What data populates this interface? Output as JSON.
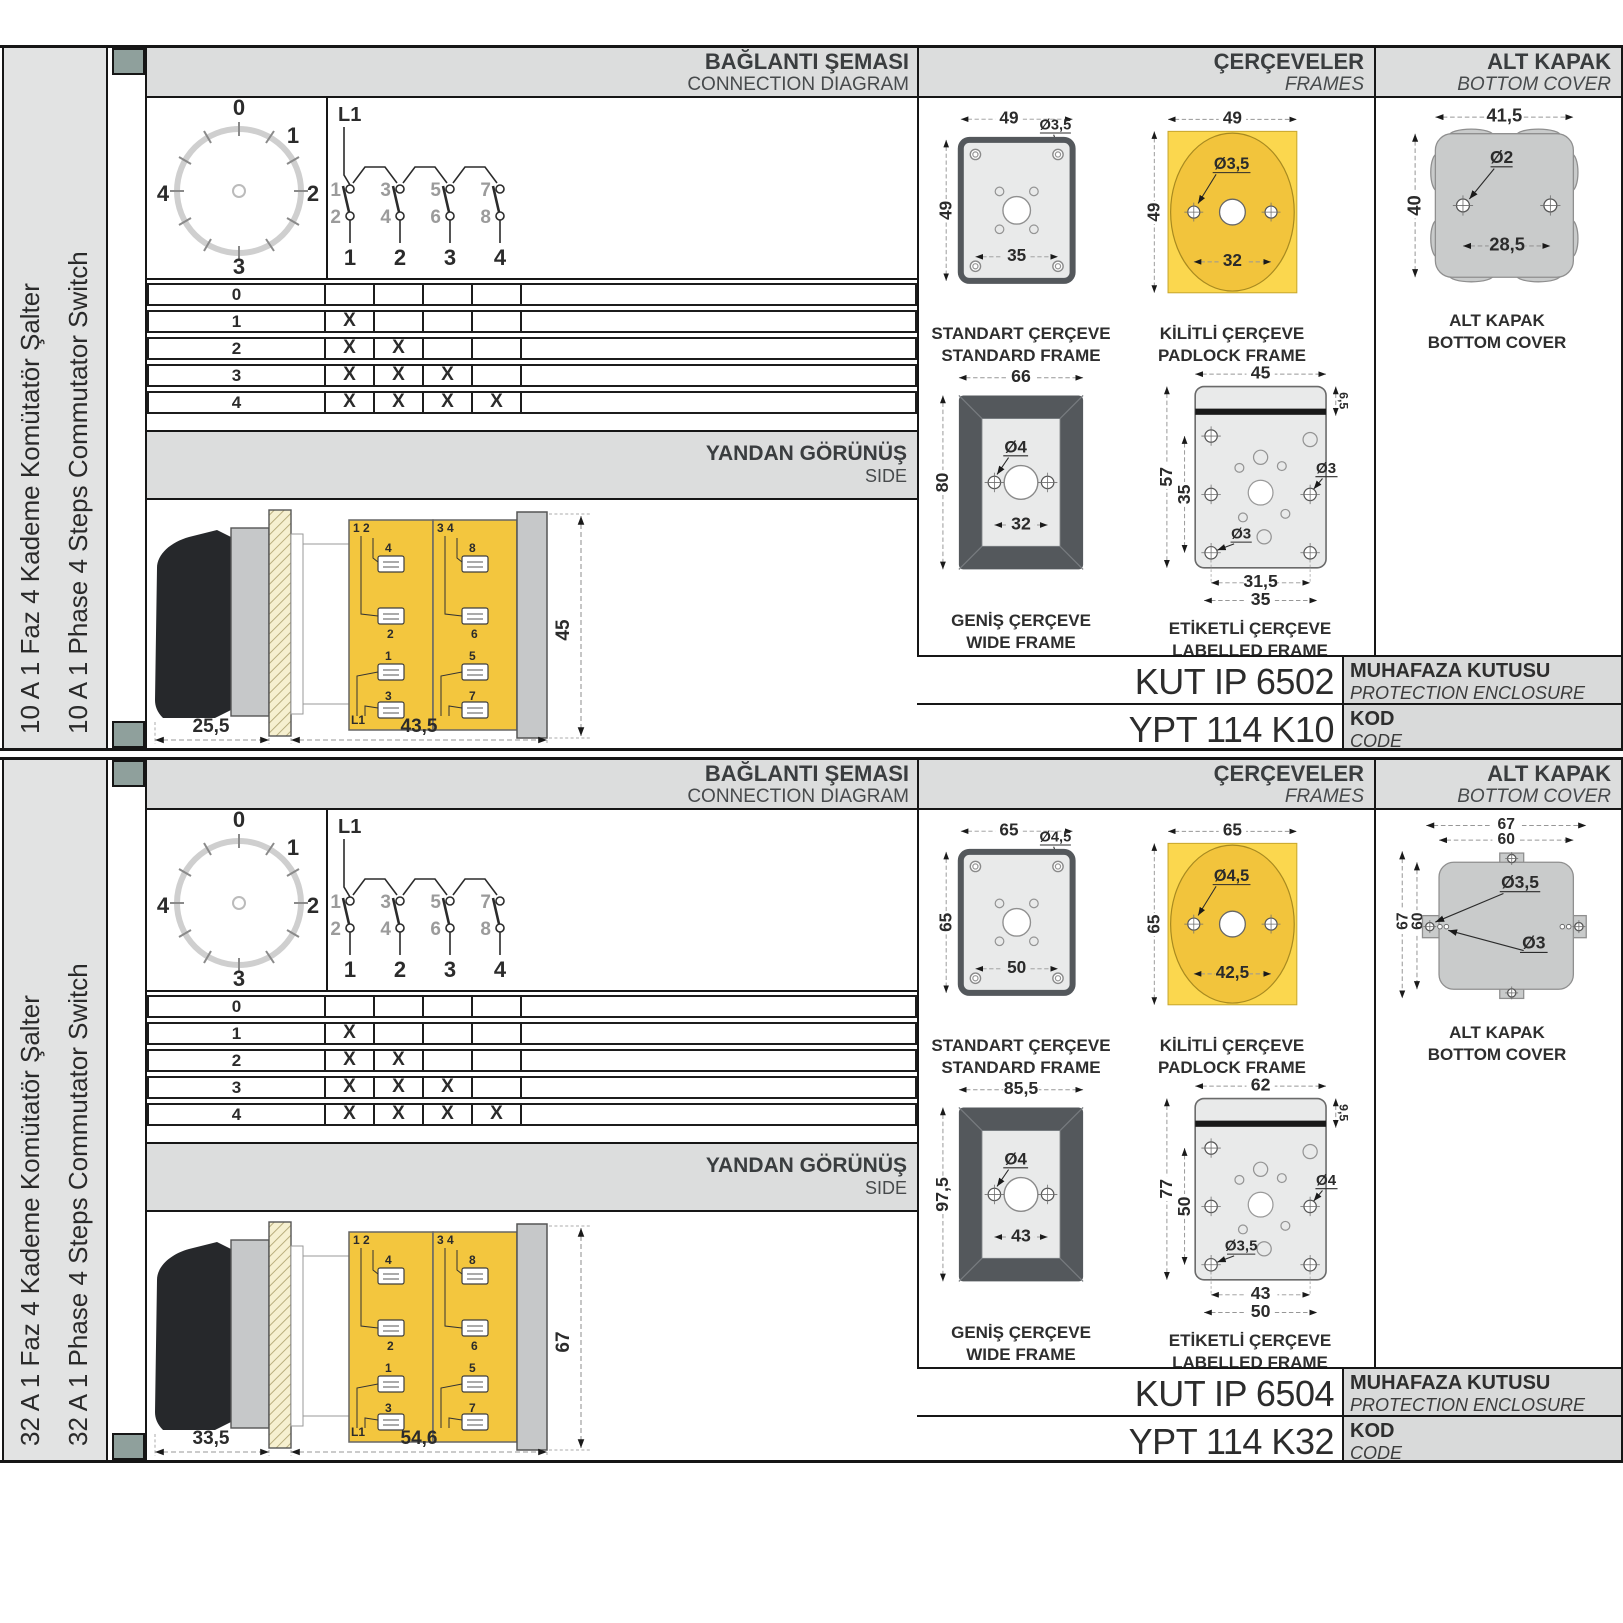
{
  "palette": {
    "band_gray": "#dcdddd",
    "sidebar_gray": "#e2e3e3",
    "spine_square": "#8fa09c",
    "frame_yellow": "#fbd74e",
    "frame_yellow_dark": "#f2c43c",
    "frame_dark": "#54585c",
    "frame_light": "#e9eaea",
    "cover_gray": "#c9cbcb",
    "line_black": "#161616"
  },
  "sections": [
    {
      "sidebar_tr": "10 A 1 Faz 4 Kademe Komütatör Şalter",
      "sidebar_en": "10 A 1 Phase 4 Steps Commutator Switch",
      "hdr": {
        "diag_tr": "BAĞLANTI ŞEMASI",
        "diag_en": "CONNECTION DIAGRAM",
        "frames_tr": "ÇERÇEVELER",
        "frames_en": "FRAMES",
        "cover_tr": "ALT KAPAK",
        "cover_en": "BOTTOM COVER",
        "side_tr": "YANDAN GÖRÜNÜŞ",
        "side_en": "SIDE"
      },
      "dial": {
        "p0": "0",
        "p1": "1",
        "p2": "2",
        "p3": "3",
        "p4": "4"
      },
      "sch": {
        "phase": "L1",
        "t1": "1",
        "t2": "3",
        "t3": "5",
        "t4": "7",
        "b1": "2",
        "b2": "4",
        "b3": "6",
        "b4": "8",
        "c1": "1",
        "c2": "2",
        "c3": "3",
        "c4": "4"
      },
      "table": {
        "rows": [
          {
            "label": "0",
            "m1": "",
            "m2": "",
            "m3": "",
            "m4": ""
          },
          {
            "label": "1",
            "m1": "X",
            "m2": "",
            "m3": "",
            "m4": ""
          },
          {
            "label": "2",
            "m1": "X",
            "m2": "X",
            "m3": "",
            "m4": ""
          },
          {
            "label": "3",
            "m1": "X",
            "m2": "X",
            "m3": "X",
            "m4": ""
          },
          {
            "label": "4",
            "m1": "X",
            "m2": "X",
            "m3": "X",
            "m4": "X"
          }
        ]
      },
      "side": {
        "dim_depth": "25,5",
        "dim_body": "43,5",
        "dim_height": "45",
        "lab_tl": "1 2",
        "lab_tr": "3 4",
        "t4": "4",
        "t8": "8",
        "t2": "2",
        "t6": "6",
        "t1": "1",
        "t3": "3",
        "t5": "5",
        "t7": "7",
        "phase": "L1"
      },
      "std": {
        "cap_tr": "STANDART ÇERÇEVE",
        "cap_en": "STANDARD FRAME",
        "w": "49",
        "h": "49",
        "hole": "Ø3,5",
        "span": "35"
      },
      "pad": {
        "cap_tr": "KİLİTLİ ÇERÇEVE",
        "cap_en": "PADLOCK FRAME",
        "w": "49",
        "h": "49",
        "hole": "Ø3,5",
        "span": "32"
      },
      "wide": {
        "cap_tr": "GENİŞ ÇERÇEVE",
        "cap_en": "WIDE FRAME",
        "w": "66",
        "h": "80",
        "hole": "Ø4",
        "span": "32"
      },
      "lab": {
        "cap_tr": "ETİKETLİ ÇERÇEVE",
        "cap_en": "LABELLED FRAME",
        "w": "45",
        "h": "57",
        "band": "6,5",
        "inner_h": "35",
        "hole_r": "Ø3",
        "hole_l": "Ø3",
        "span1": "31,5",
        "span2": "35"
      },
      "cover": {
        "cap_tr": "ALT KAPAK",
        "cap_en": "BOTTOM COVER",
        "w": "41,5",
        "h": "40",
        "hole": "Ø2",
        "span": "28,5"
      },
      "codes": {
        "enclosure": "KUT IP 6502",
        "enc_tr": "MUHAFAZA KUTUSU",
        "enc_en": "PROTECTION ENCLOSURE",
        "code": "YPT 114 K10",
        "kod_tr": "KOD",
        "kod_en": "CODE"
      }
    },
    {
      "sidebar_tr": "32 A 1 Faz 4 Kademe Komütatör Şalter",
      "sidebar_en": "32 A 1 Phase 4 Steps Commutator Switch",
      "hdr": {
        "diag_tr": "BAĞLANTI ŞEMASI",
        "diag_en": "CONNECTION DIAGRAM",
        "frames_tr": "ÇERÇEVELER",
        "frames_en": "FRAMES",
        "cover_tr": "ALT KAPAK",
        "cover_en": "BOTTOM COVER",
        "side_tr": "YANDAN GÖRÜNÜŞ",
        "side_en": "SIDE"
      },
      "dial": {
        "p0": "0",
        "p1": "1",
        "p2": "2",
        "p3": "3",
        "p4": "4"
      },
      "sch": {
        "phase": "L1",
        "t1": "1",
        "t2": "3",
        "t3": "5",
        "t4": "7",
        "b1": "2",
        "b2": "4",
        "b3": "6",
        "b4": "8",
        "c1": "1",
        "c2": "2",
        "c3": "3",
        "c4": "4"
      },
      "table": {
        "rows": [
          {
            "label": "0",
            "m1": "",
            "m2": "",
            "m3": "",
            "m4": ""
          },
          {
            "label": "1",
            "m1": "X",
            "m2": "",
            "m3": "",
            "m4": ""
          },
          {
            "label": "2",
            "m1": "X",
            "m2": "X",
            "m3": "",
            "m4": ""
          },
          {
            "label": "3",
            "m1": "X",
            "m2": "X",
            "m3": "X",
            "m4": ""
          },
          {
            "label": "4",
            "m1": "X",
            "m2": "X",
            "m3": "X",
            "m4": "X"
          }
        ]
      },
      "side": {
        "dim_depth": "33,5",
        "dim_body": "54,6",
        "dim_height": "67",
        "lab_tl": "1 2",
        "lab_tr": "3 4",
        "t4": "4",
        "t8": "8",
        "t2": "2",
        "t6": "6",
        "t1": "1",
        "t3": "3",
        "t5": "5",
        "t7": "7",
        "phase": "L1"
      },
      "std": {
        "cap_tr": "STANDART ÇERÇEVE",
        "cap_en": "STANDARD FRAME",
        "w": "65",
        "h": "65",
        "hole": "Ø4,5",
        "span": "50"
      },
      "pad": {
        "cap_tr": "KİLİTLİ ÇERÇEVE",
        "cap_en": "PADLOCK FRAME",
        "w": "65",
        "h": "65",
        "hole": "Ø4,5",
        "span": "42,5"
      },
      "wide": {
        "cap_tr": "GENİŞ ÇERÇEVE",
        "cap_en": "WIDE FRAME",
        "w": "85,5",
        "h": "97,5",
        "hole": "Ø4",
        "span": "43"
      },
      "lab": {
        "cap_tr": "ETİKETLİ ÇERÇEVE",
        "cap_en": "LABELLED FRAME",
        "w": "62",
        "h": "77",
        "band": "9,5",
        "inner_h": "50",
        "hole_r": "Ø4",
        "hole_l": "Ø3,5",
        "span1": "43",
        "span2": "50"
      },
      "cover": {
        "cap_tr": "ALT KAPAK",
        "cap_en": "BOTTOM COVER",
        "w": "67",
        "w2": "60",
        "h": "67",
        "h2": "60",
        "hole": "Ø3,5",
        "hole2": "Ø3"
      },
      "codes": {
        "enclosure": "KUT IP 6504",
        "enc_tr": "MUHAFAZA KUTUSU",
        "enc_en": "PROTECTION ENCLOSURE",
        "code": "YPT 114 K32",
        "kod_tr": "KOD",
        "kod_en": "CODE"
      }
    }
  ]
}
